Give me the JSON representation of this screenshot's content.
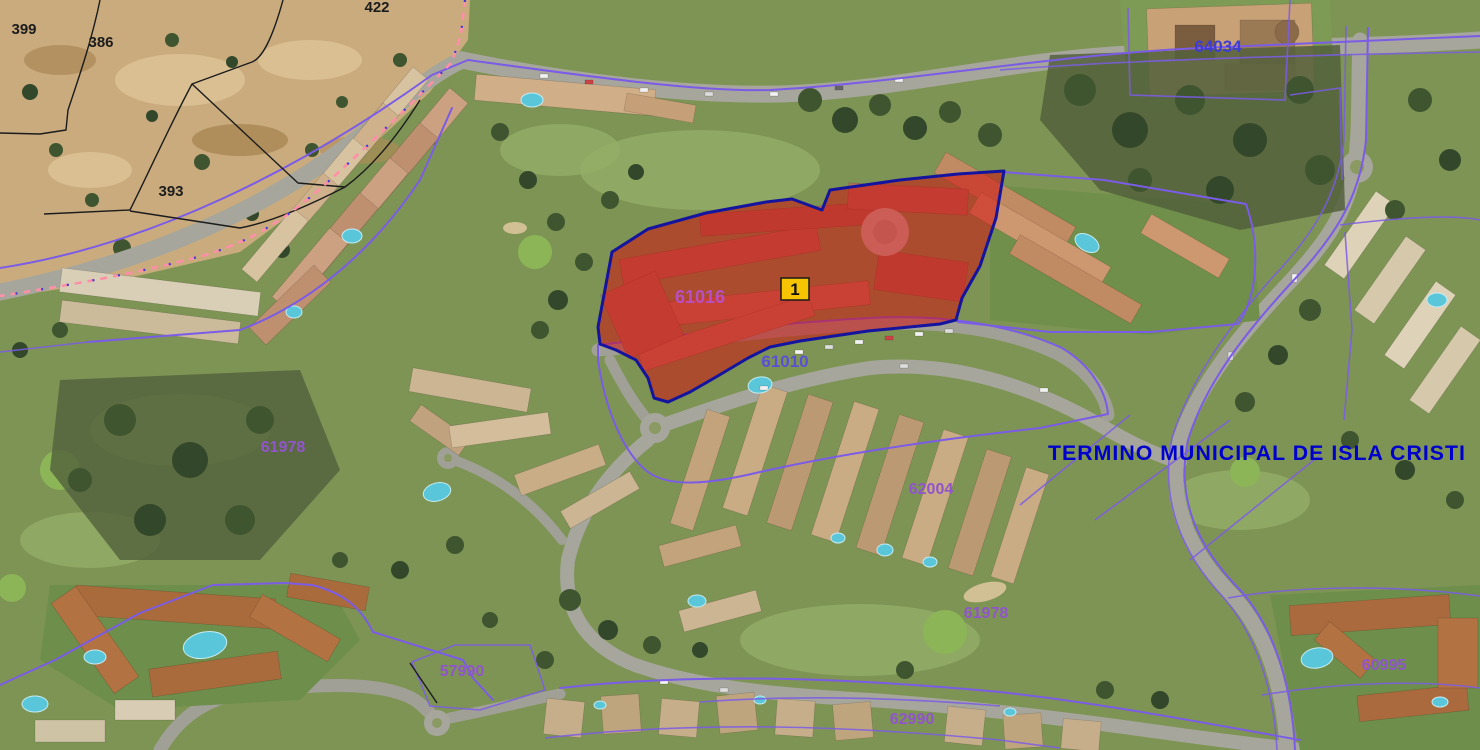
{
  "map": {
    "type": "cadastral-aerial-view",
    "municipal_boundary_text": "TERMINO MUNICIPAL DE ISLA CRISTI",
    "marker_label": "1",
    "selected_parcel_id": "61016"
  },
  "parcel_labels": {
    "rustic_399": "399",
    "rustic_386": "386",
    "rustic_422": "422",
    "rustic_393": "393",
    "urban_64034": "64034",
    "urban_61016": "61016",
    "urban_61010": "61010",
    "urban_61978_west": "61978",
    "urban_62004": "62004",
    "urban_61978_east": "61978",
    "urban_57990": "57990",
    "urban_62990": "62990",
    "urban_60995": "60995"
  },
  "colors": {
    "cadastral_line": "#7b5ce6",
    "selected_parcel_fill": "#d01010",
    "selected_parcel_border": "#14149e",
    "marker_fill": "#f6c500",
    "urban_label_blue": "#3d3dd6",
    "urban_label_blue_violet": "#5a4fd8",
    "urban_label_purple": "#9055cc",
    "selected_label_magenta": "#b84fc4",
    "municipal_text_blue": "#0000cd",
    "rustic_line_black": "#1c1c1c",
    "boundary_dashed_pink": "#ff8fa8"
  }
}
